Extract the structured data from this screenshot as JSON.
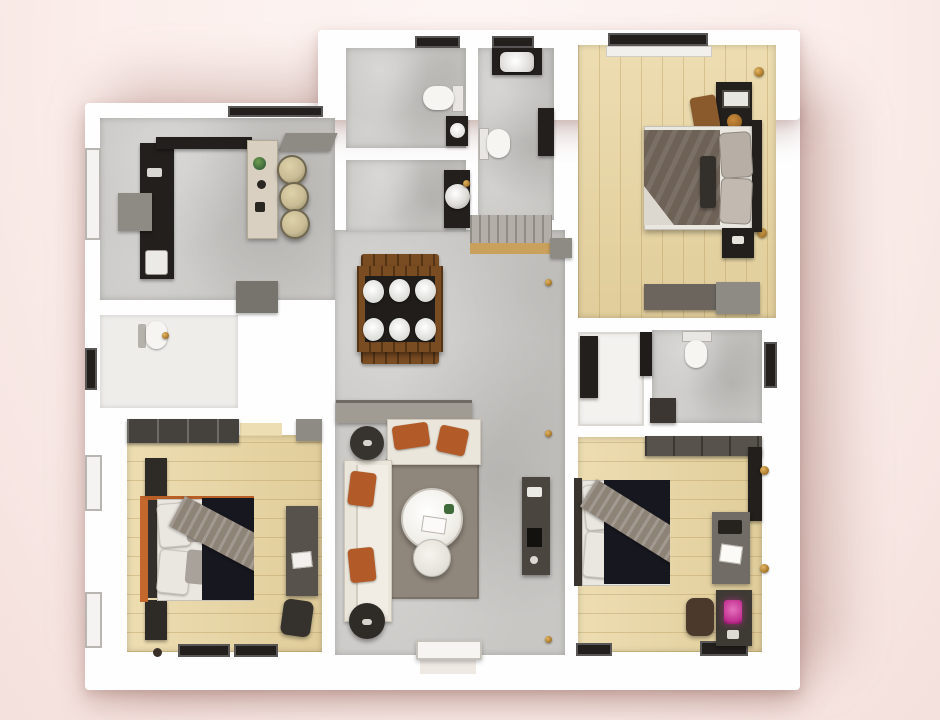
{
  "scene": {
    "type": "3d-floor-plan-top-down-render",
    "description": "Top-down 3D rendered floor plan of a three-bedroom apartment on a light pink backdrop"
  },
  "palette": {
    "bgTop": "#fdf6f4",
    "bg": "#fbeeeb",
    "bgEdge": "#f4e0dc",
    "shadowCol": "rgba(150,95,85,0.30)",
    "wall": "#fefefe",
    "lightFloor": "#efedea",
    "concrete": "#c8c7c4",
    "wood": "#ead8a6",
    "dark": "#221f1c",
    "charcoal": "#37332e",
    "grayFurn": "#8e8a84",
    "sofa": "#ebe6db",
    "rust": "#b25a28",
    "rug": "#90877c",
    "navy": "#17171f",
    "throwGray": "#8d8377",
    "pillow": "#eae6e0",
    "orange": "#c4672c",
    "stool": "#c9bc96",
    "tableWood": "#7a4c22",
    "tableDark": "#201d1a",
    "brass": "#ad7d2f",
    "magenta": "#c12f90",
    "blanketMaster": "#6e6257",
    "white": "#f6f5f2",
    "steel": "#a09b93",
    "green": "#3f6b3a"
  },
  "rooms": {
    "kitchen": {
      "label": "Kitchen / open hall"
    },
    "bath1": {
      "label": "Bathroom 1 (WC)"
    },
    "bath2": {
      "label": "Bathroom 2"
    },
    "laundry": {
      "label": "Laundry nook"
    },
    "utility": {
      "label": "Utility WC"
    },
    "master": {
      "label": "Master bedroom"
    },
    "hallDining": {
      "label": "Hallway / dining area"
    },
    "living": {
      "label": "Living room"
    },
    "bedroomLeft": {
      "label": "Bedroom (bottom left)"
    },
    "bedroomRight": {
      "label": "Bedroom (bottom right)"
    },
    "bath3": {
      "label": "Bathroom 3"
    },
    "closet": {
      "label": "Closet"
    }
  },
  "furniture": {
    "diningSeats": 6,
    "barStools": 3,
    "beds": 3,
    "items": [
      "kitchen-counter",
      "kitchen-island",
      "bar-stools",
      "dining-table",
      "sofa-l-shape",
      "coffee-table",
      "side-table",
      "poufs",
      "media-console",
      "tv-shelf",
      "master-bed",
      "nightstands",
      "dresser-bench",
      "wardrobes",
      "desks",
      "desk-chair",
      "washing-machine",
      "toilets",
      "sinks",
      "entry-door"
    ]
  }
}
